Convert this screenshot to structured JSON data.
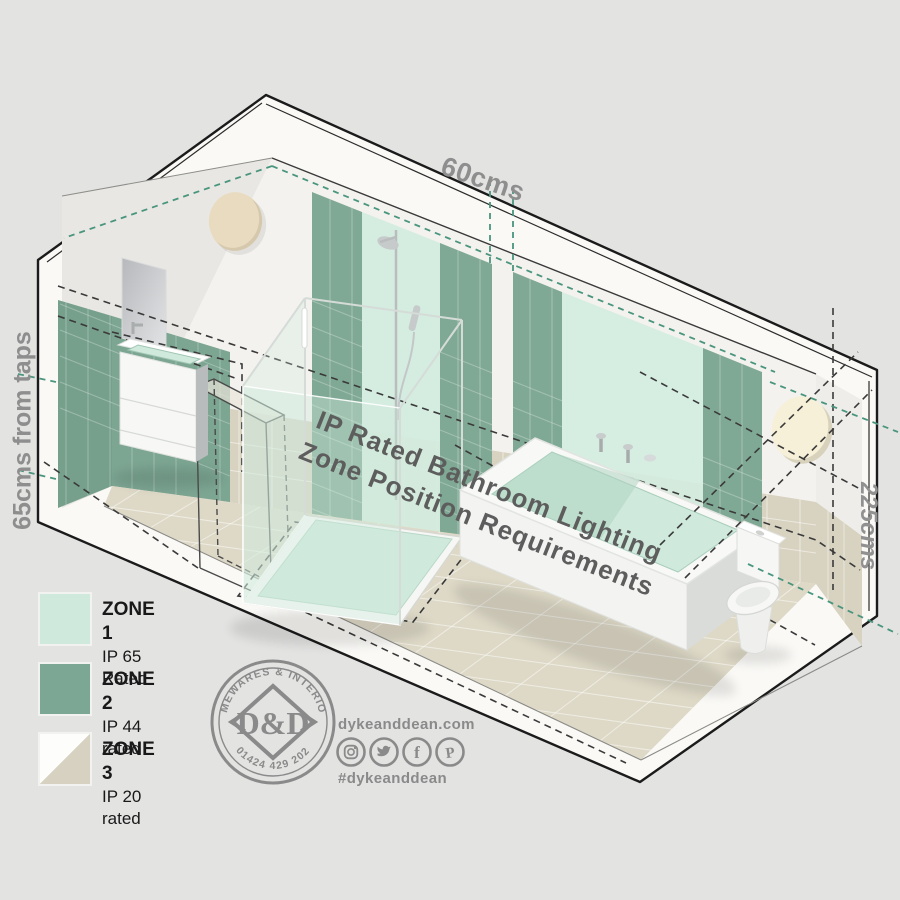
{
  "background": "#e3e3e2",
  "measurements": {
    "top": "60cms",
    "left": "65cms from taps",
    "right": "225cms"
  },
  "floor_title": {
    "line1": "IP Rated Bathroom Lighting",
    "line2": "Zone Position Requirements"
  },
  "legend": {
    "items": [
      {
        "zone": "ZONE 1",
        "rating": "IP 65 Rated",
        "color": "#cfe9dc"
      },
      {
        "zone": "ZONE 2",
        "rating": "IP 44 rated",
        "color": "#7da795"
      },
      {
        "zone": "ZONE 3",
        "rating": "IP 20 rated",
        "color_top": "#fdfdfb",
        "color_bottom": "#d6d1c0"
      }
    ]
  },
  "logo": {
    "arc_top": "HOMEWARES & INTERIORS",
    "arc_bottom": "01424 429 202",
    "monogram": "D&D"
  },
  "social": {
    "website": "dykeanddean.com",
    "hashtag": "#dykeanddean",
    "icons": [
      "instagram-icon",
      "twitter-icon",
      "facebook-icon",
      "pinterest-icon"
    ]
  },
  "scene": {
    "fixtures": [
      "wall-mirror",
      "basin-vanity",
      "shower-enclosure",
      "bathtub",
      "toilet",
      "wall-light-left",
      "wall-light-right",
      "door-zone-outline"
    ],
    "colors": {
      "zone1_mint": "#d3ecdf",
      "zone2_green": "#80a995",
      "wall_concrete": "#f3f2ee",
      "tile_beige": "#d8d2c0",
      "floor_beige": "#ded9c7",
      "dash_teal": "#49957e",
      "dash_dark": "#3a3a3a",
      "outline": "#1b1b1b"
    }
  }
}
